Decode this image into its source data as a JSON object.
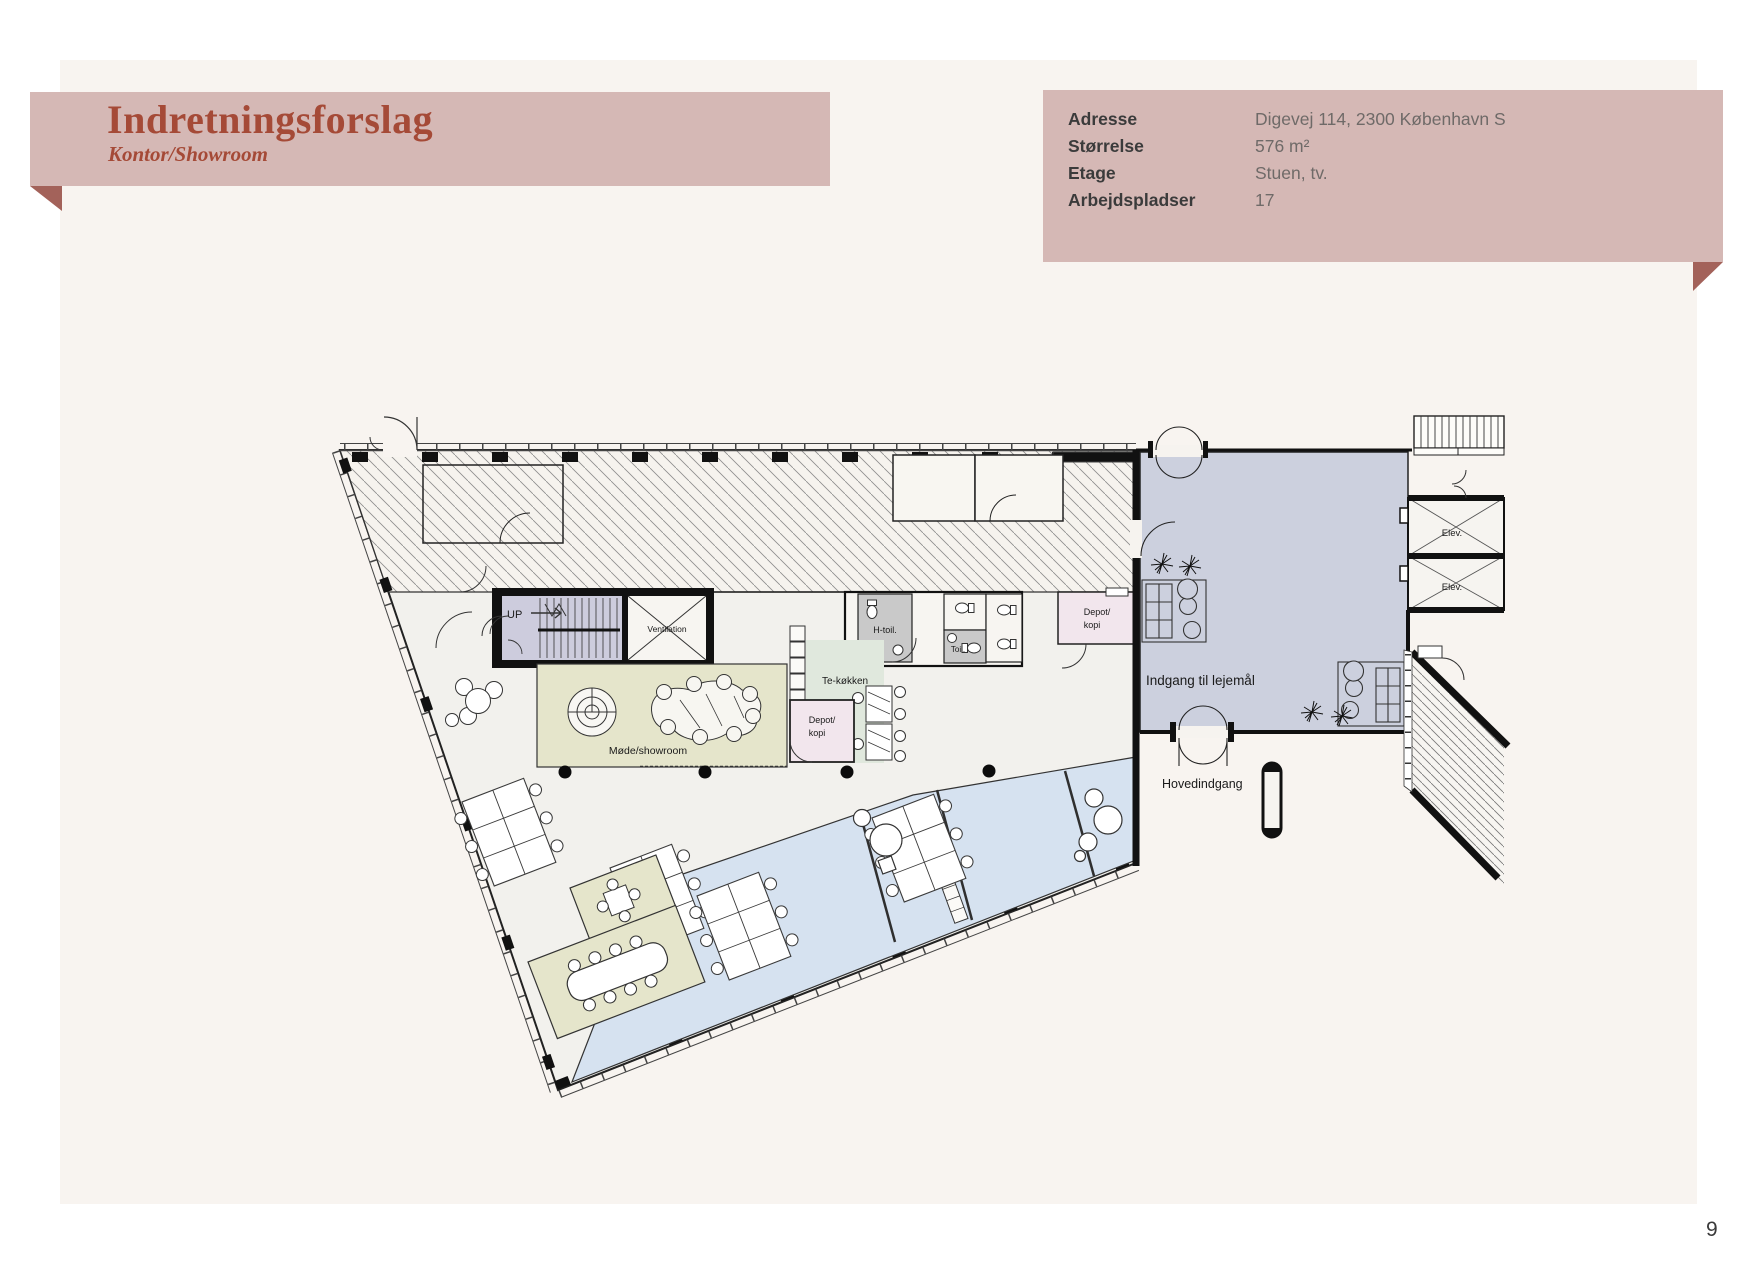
{
  "banner": {
    "title": "Indretningsforslag",
    "subtitle": "Kontor/Showroom"
  },
  "info_panel": {
    "rows": [
      {
        "label": "Adresse",
        "value": "Digevej 114, 2300 København S"
      },
      {
        "label": "Størrelse",
        "value": "576 m²"
      },
      {
        "label": "Etage",
        "value": "Stuen, tv."
      },
      {
        "label": "Arbejdspladser",
        "value": "17"
      }
    ]
  },
  "floor_plan": {
    "labels": {
      "stair_up": "UP",
      "ventilation": "Ventilation",
      "meeting_showroom": "Møde/showroom",
      "tea_kitchen": "Te-køkken",
      "depot_line1": "Depot/",
      "depot_line2": "kopi",
      "h_toilet": "H-toil.",
      "toilet": "Toil.",
      "tenancy_entrance": "Indgang til lejemål",
      "main_entrance": "Hovedindgang",
      "elevator": "Elev."
    }
  },
  "page": {
    "number": "9"
  },
  "colors": {
    "accent_pink": "#d5b8b5",
    "fold_dark": "#a3625a",
    "title_red": "#a54a37",
    "cream_background": "#f8f4f0",
    "office_blue": "#d6e2f0",
    "common_area_blue": "#ccd0de",
    "showroom_green": "#e5e5cb",
    "kitchen_green": "#e0e8dd",
    "depot_pink": "#f2e6ed",
    "stair_purple": "#cdccdd",
    "toilet_grey": "#c9c9c9"
  }
}
